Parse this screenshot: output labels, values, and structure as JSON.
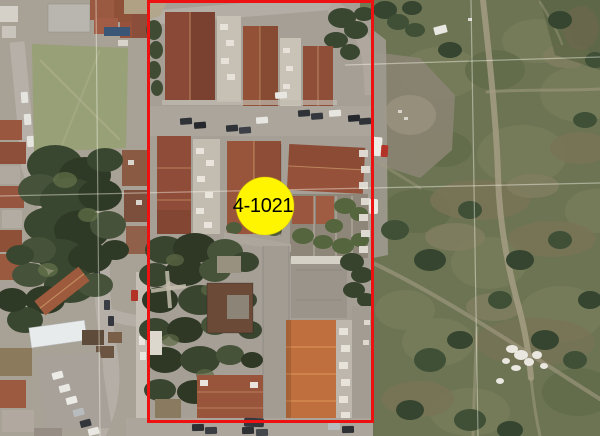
{
  "window": {
    "width": 600,
    "height": 436
  },
  "map": {
    "type": "satellite-aerial-view",
    "marker": {
      "label": "4-1021"
    },
    "colors": {
      "boundary_red": "#ee1111",
      "marker_yellow": "#fff500",
      "marker_text": "#000000",
      "gridline_white": "#fffdf0"
    }
  }
}
